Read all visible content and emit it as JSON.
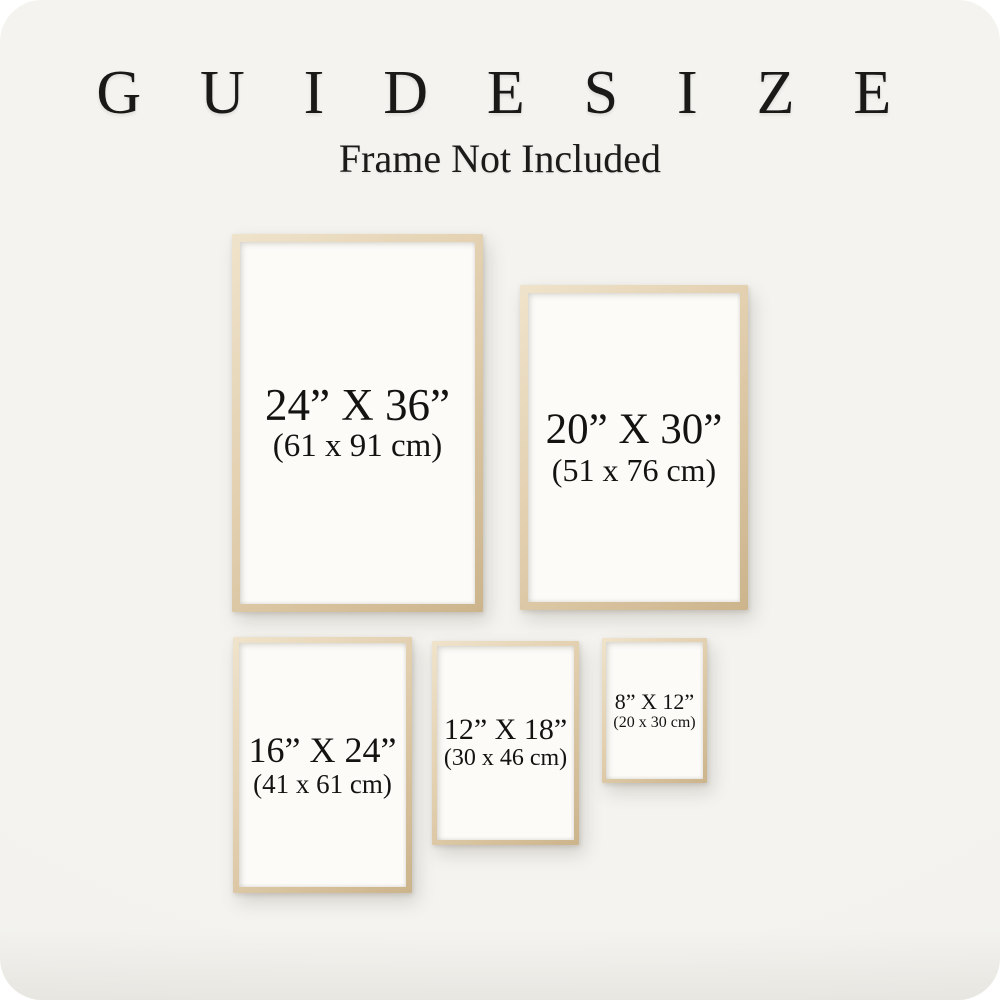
{
  "header": {
    "title": "G U I D E   S I Z E",
    "subtitle": "Frame Not Included"
  },
  "frames": [
    {
      "name": "24x36",
      "inches": "24” X 36”",
      "cm": "(61 x 91 cm)"
    },
    {
      "name": "20x30",
      "inches": "20” X 30”",
      "cm": "(51 x 76 cm)"
    },
    {
      "name": "16x24",
      "inches": "16” X 24”",
      "cm": "(41 x 61 cm)"
    },
    {
      "name": "12x18",
      "inches": "12” X 18”",
      "cm": "(30 x 46 cm)"
    },
    {
      "name": "8x12",
      "inches": "8” X 12”",
      "cm": "(20 x 30 cm)"
    }
  ],
  "colors": {
    "background": "#f4f3ef",
    "frame_wood": "#e2cfae",
    "frame_wood_dark": "#ccb48c",
    "frame_wood_light": "#efe3cb",
    "paper": "#fcfbf8",
    "text": "#141312"
  }
}
